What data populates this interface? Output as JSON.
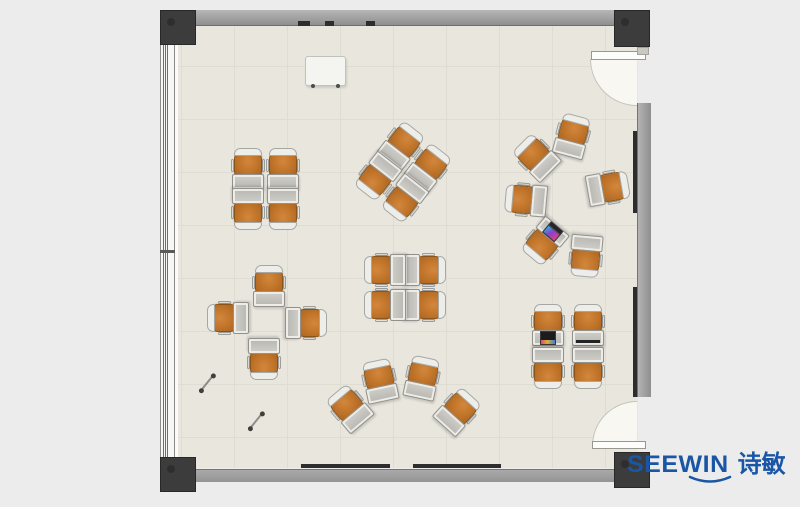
{
  "branding": {
    "logo_latin": "SEEWIN",
    "logo_cjk": "诗敏",
    "logo_color": "#1a56a6"
  },
  "palette": {
    "background": "#ececec",
    "floor": "#e9e6de",
    "tile_line": "#dfdcd3",
    "wall": "#9c9c9c",
    "post": "#3c3c3c",
    "chair_orange": "#c2762d",
    "chair_back": "#ededea",
    "desk_gray": "#c6c5c0",
    "door_leaf": "#fdfdfb"
  },
  "floorplan": {
    "units": [
      {
        "cluster": "quad-top-left",
        "x": 248,
        "y": 170,
        "rot": 0
      },
      {
        "cluster": "quad-top-left",
        "x": 283,
        "y": 170,
        "rot": 0
      },
      {
        "cluster": "quad-top-left",
        "x": 248,
        "y": 208,
        "rot": 180
      },
      {
        "cluster": "quad-top-left",
        "x": 283,
        "y": 208,
        "rot": 180
      },
      {
        "cluster": "quad-top-center-rotated",
        "x": 401,
        "y": 146,
        "rot": 38
      },
      {
        "cluster": "quad-top-center-rotated",
        "x": 428,
        "y": 168,
        "rot": 38
      },
      {
        "cluster": "quad-top-center-rotated",
        "x": 378,
        "y": 176,
        "rot": 218
      },
      {
        "cluster": "quad-top-center-rotated",
        "x": 405,
        "y": 198,
        "rot": 218
      },
      {
        "cluster": "circle-right",
        "x": 572,
        "y": 137,
        "rot": 15
      },
      {
        "cluster": "circle-right",
        "x": 537,
        "y": 158,
        "rot": 315
      },
      {
        "cluster": "circle-right",
        "x": 527,
        "y": 200,
        "rot": 275
      },
      {
        "cluster": "circle-right",
        "x": 607,
        "y": 188,
        "rot": 80
      },
      {
        "cluster": "circle-right",
        "x": 545,
        "y": 241,
        "rot": 220,
        "addon": "laptop-color"
      },
      {
        "cluster": "circle-right",
        "x": 586,
        "y": 255,
        "rot": 185
      },
      {
        "cluster": "cross-mid-left",
        "x": 269,
        "y": 287,
        "rot": 0
      },
      {
        "cluster": "cross-mid-left",
        "x": 229,
        "y": 318,
        "rot": 270
      },
      {
        "cluster": "cross-mid-left",
        "x": 305,
        "y": 323,
        "rot": 90
      },
      {
        "cluster": "cross-mid-left",
        "x": 264,
        "y": 358,
        "rot": 180
      },
      {
        "cluster": "quad-center",
        "x": 424,
        "y": 270,
        "rot": 90
      },
      {
        "cluster": "quad-center",
        "x": 424,
        "y": 305,
        "rot": 90
      },
      {
        "cluster": "quad-center",
        "x": 386,
        "y": 270,
        "rot": 270
      },
      {
        "cluster": "quad-center",
        "x": 386,
        "y": 305,
        "rot": 270
      },
      {
        "cluster": "fan-bottom-center",
        "x": 350,
        "y": 409,
        "rot": 320
      },
      {
        "cluster": "fan-bottom-center",
        "x": 380,
        "y": 382,
        "rot": 348
      },
      {
        "cluster": "fan-bottom-center",
        "x": 422,
        "y": 379,
        "rot": 12
      },
      {
        "cluster": "fan-bottom-center",
        "x": 457,
        "y": 412,
        "rot": 42
      },
      {
        "cluster": "quad-bottom-right",
        "x": 548,
        "y": 326,
        "rot": 0,
        "addon": "laptop-dark"
      },
      {
        "cluster": "quad-bottom-right",
        "x": 588,
        "y": 326,
        "rot": 0,
        "addon": "tablet"
      },
      {
        "cluster": "quad-bottom-right",
        "x": 548,
        "y": 367,
        "rot": 180
      },
      {
        "cluster": "quad-bottom-right",
        "x": 588,
        "y": 367,
        "rot": 180
      }
    ]
  }
}
